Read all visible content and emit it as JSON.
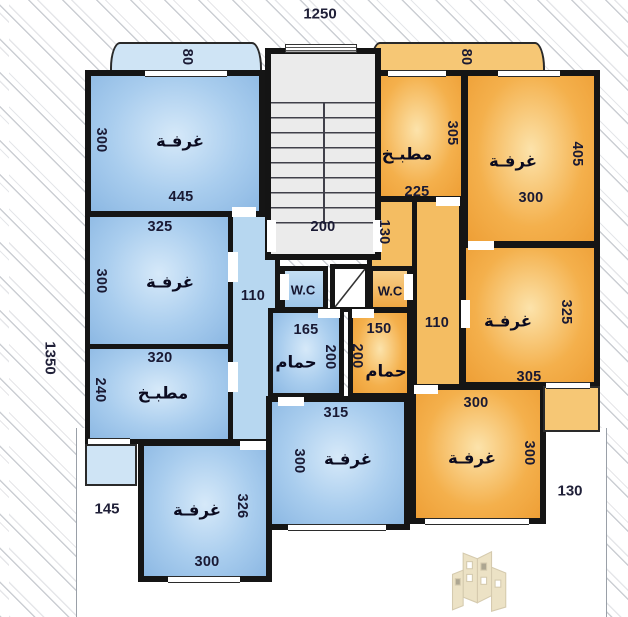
{
  "site": {
    "width_label": "1250",
    "depth_label": "1350",
    "yard_left_label": "145",
    "yard_right_label": "130"
  },
  "core": {
    "stairs_label": "200"
  },
  "blue_unit": {
    "balcony": {
      "depth": "80"
    },
    "corridor": {
      "width": "110"
    },
    "rooms": {
      "bedroom_top": {
        "label": "غرفـة",
        "h": "300",
        "w": "445"
      },
      "bedroom_mid": {
        "label": "غرفـة",
        "w": "325",
        "h": "300"
      },
      "kitchen": {
        "label": "مطبـخ",
        "w": "320",
        "h": "240"
      },
      "wc": {
        "label": "W.C"
      },
      "bath": {
        "label": "حمام",
        "w": "165",
        "h": "200"
      },
      "bedroom_bottom_mid": {
        "label": "غرفـة",
        "w": "315",
        "h": "300"
      },
      "bedroom_bottom_left": {
        "label": "غرفـة",
        "h": "326",
        "w": "300"
      }
    }
  },
  "orange_unit": {
    "balcony": {
      "depth": "80"
    },
    "corridor": {
      "entry": "130",
      "width": "110"
    },
    "rooms": {
      "kitchen": {
        "label": "مطبـخ",
        "h": "305",
        "w": "225"
      },
      "bedroom_top": {
        "label": "غرفـة",
        "h": "405",
        "w": "300"
      },
      "wc": {
        "label": "W.C"
      },
      "bath": {
        "label": "حمام",
        "w": "150",
        "h": "200"
      },
      "bedroom_mid": {
        "label": "غرفـة",
        "h": "325",
        "w": "305"
      },
      "bedroom_bottom": {
        "label": "غرفـة",
        "w": "300",
        "h": "300"
      }
    }
  }
}
